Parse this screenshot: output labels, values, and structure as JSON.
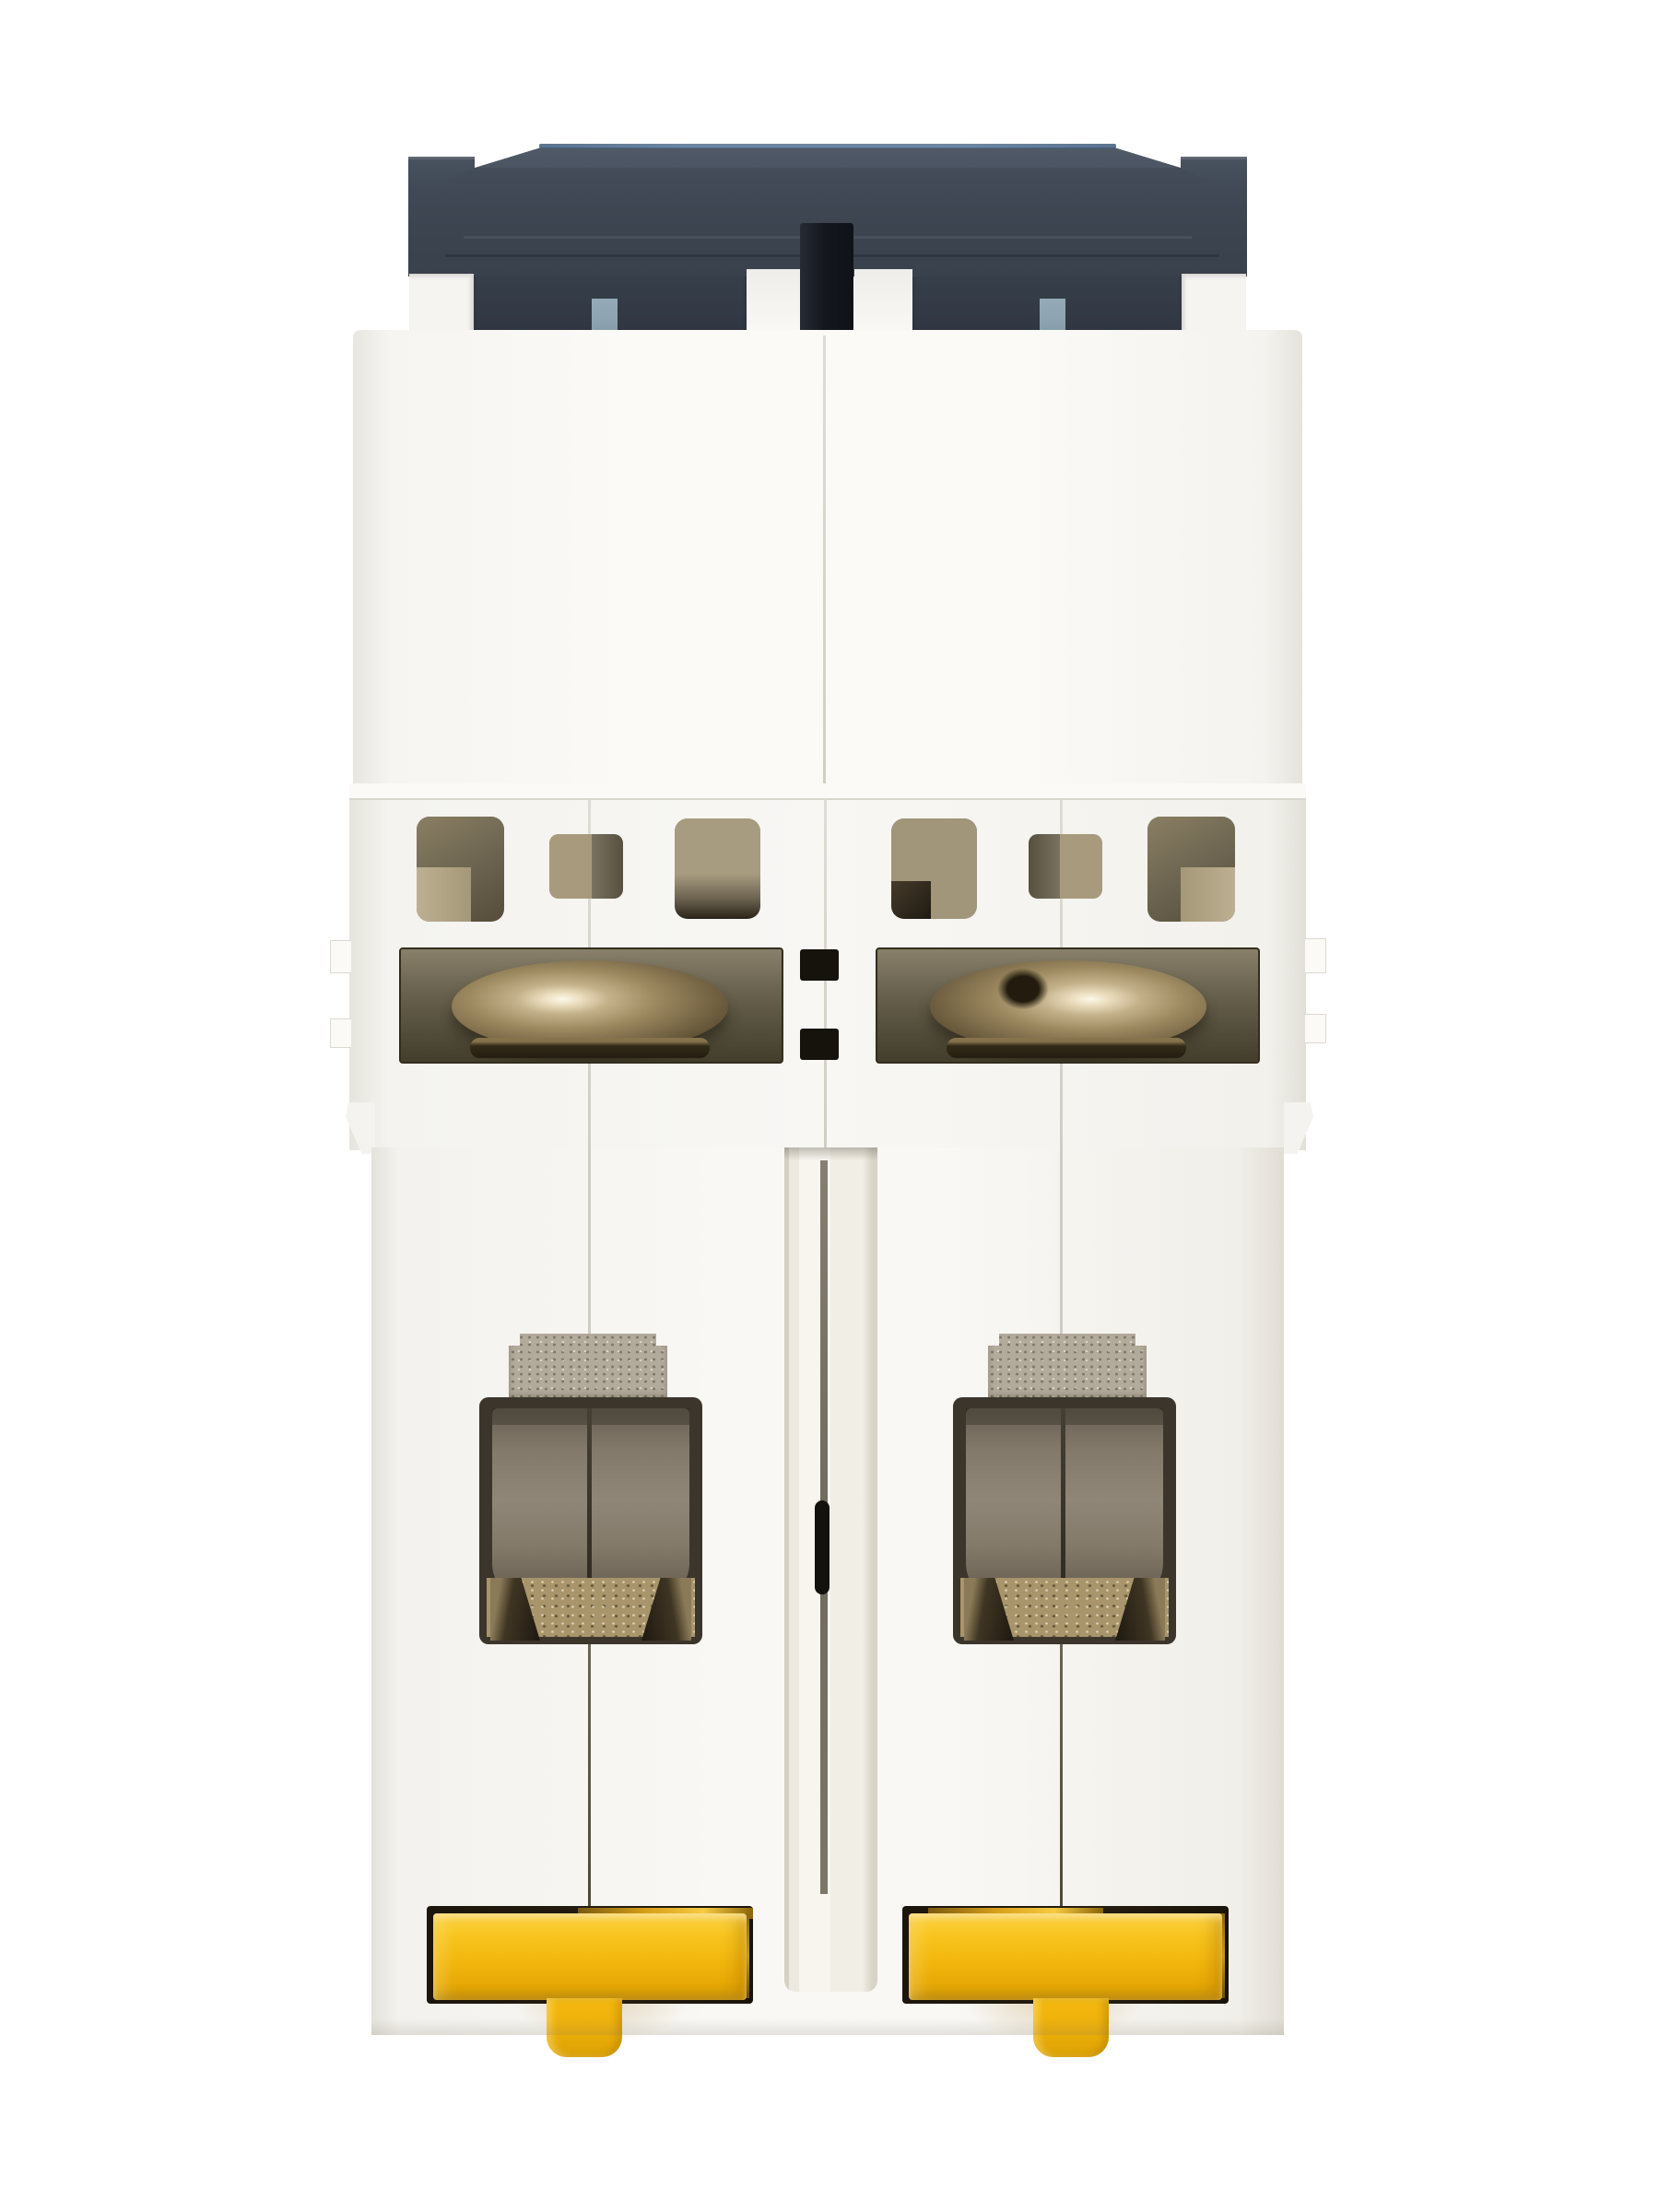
{
  "photo": {
    "subject": "two-pole-din-rail-circuit-breaker-rear-bottom-view",
    "modules": 2,
    "palette": {
      "background": "#ffffff",
      "plastic_white": "#f8f7f4",
      "plastic_shadow": "#e2dfd8",
      "cap_dark": "#3b434f",
      "cap_top": "#4e5765",
      "cap_rim_blue": "#527092",
      "toggle_pin_black": "#14171d",
      "indicator_blue_gray": "#8da2b0",
      "vent_khaki": "#a1957a",
      "vent_dark": "#554d3a",
      "screw_bronze": "#9c8960",
      "screw_highlight": "#fbf8ea",
      "recess_olive": "#544e3c",
      "clamp_taupe": "#8f8677",
      "terminal_metal": "#b2aa9b",
      "bronze_floor": "#a8956b",
      "clip_yellow": "#f2b70e",
      "clip_yellow_highlight": "#ffd648",
      "clip_yellow_shadow": "#d29b03",
      "clip_recess_brown": "#251d11",
      "amber_metal": "#d9a019"
    },
    "parts": [
      "toggle-cap",
      "toggle-tie-pin",
      "pole-indicator-windows",
      "housing-upper",
      "vent-openings",
      "terminal-screws",
      "terminal-metal-tabs",
      "wire-clamp-cavities",
      "center-channel",
      "din-rail-clips",
      "din-rail-clip-tabs"
    ]
  }
}
